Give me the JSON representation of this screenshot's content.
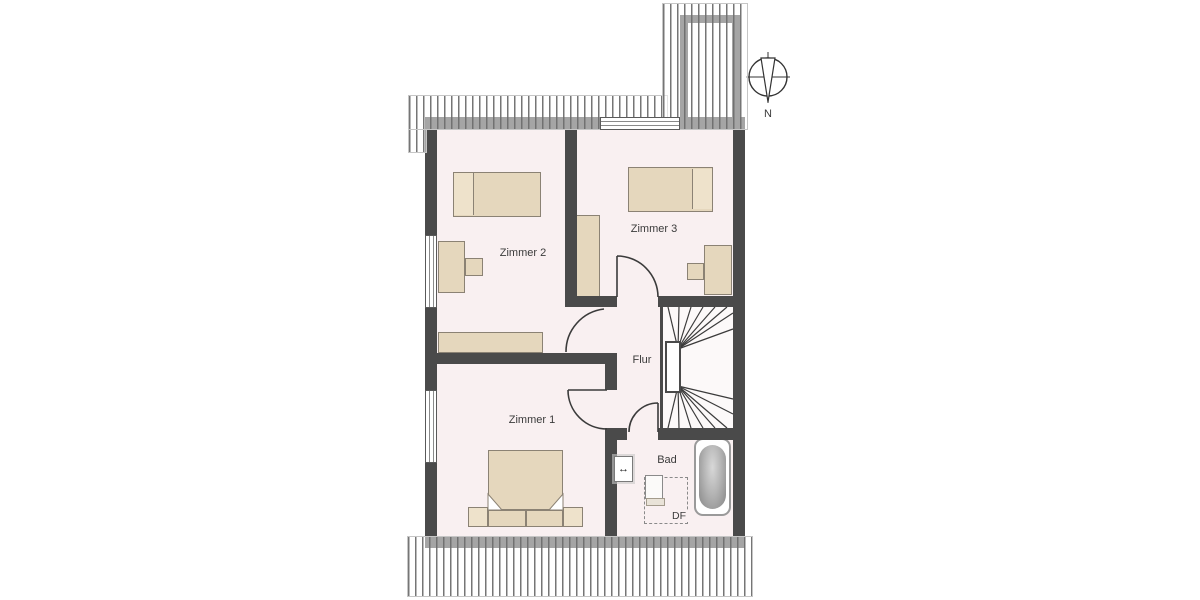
{
  "compass": {
    "north_label": "N"
  },
  "rooms": [
    {
      "id": "zimmer2",
      "label": "Zimmer 2"
    },
    {
      "id": "zimmer3",
      "label": "Zimmer 3"
    },
    {
      "id": "zimmer1",
      "label": "Zimmer 1"
    },
    {
      "id": "flur",
      "label": "Flur"
    },
    {
      "id": "bad",
      "label": "Bad"
    }
  ],
  "annotations": {
    "roof_window_label": "DF"
  },
  "symbols": {
    "width_arrow": "↔"
  },
  "colors": {
    "wall": "#4a4a4a",
    "room-fill": "#f9f0f1",
    "stair-fill": "#fcf9f9",
    "furniture-fill": "#e5d7bd",
    "furniture-light": "#eee2cb",
    "furniture-border": "#8b8274",
    "door-line": "#3b3b3b",
    "label-color": "#3b3b3b",
    "tub-border": "#9a9a9a"
  }
}
